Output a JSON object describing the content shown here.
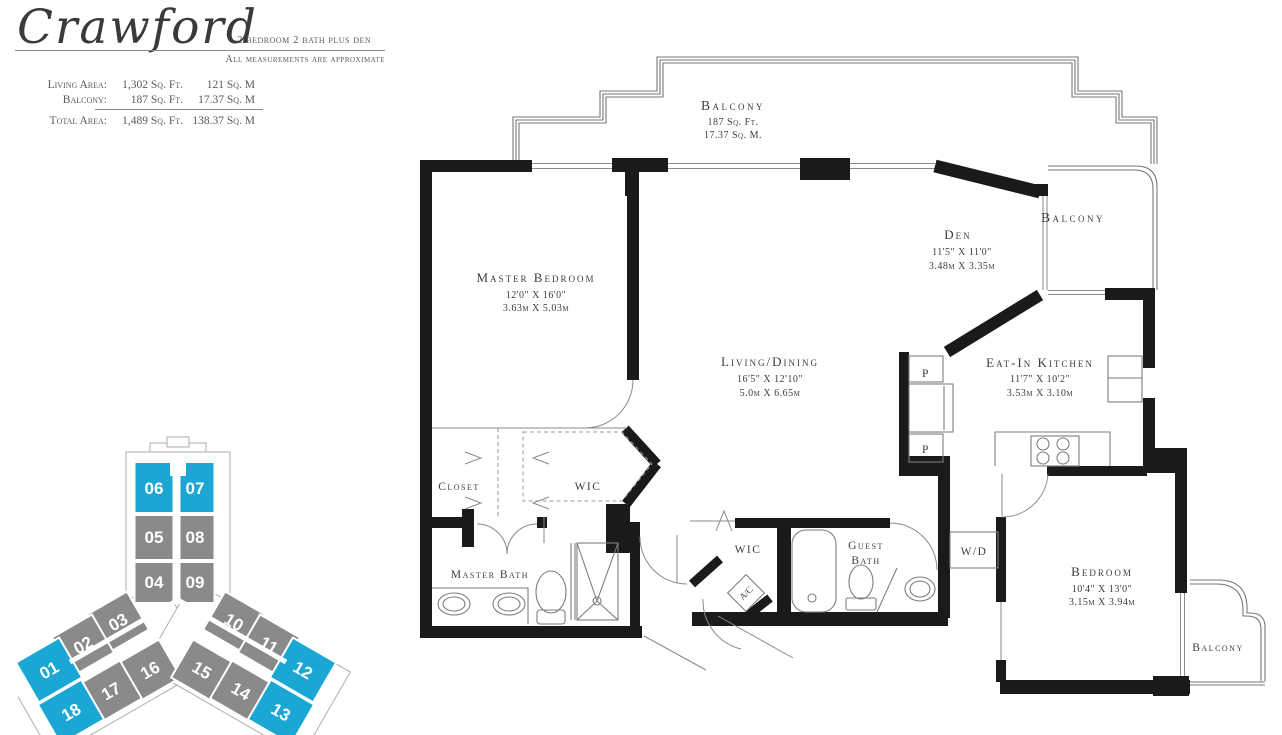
{
  "header": {
    "plan_name": "Crawford",
    "subtitle": "2 bedroom 2 bath plus den",
    "note": "All measurements are approximate",
    "stats": {
      "rows": [
        {
          "label": "Living Area:",
          "sqft": "1,302 Sq. Ft.",
          "sqm": "121 Sq. M"
        },
        {
          "label": "Balcony:",
          "sqft": "187 Sq. Ft.",
          "sqm": "17.37 Sq. M"
        },
        {
          "label": "Total Area:",
          "sqft": "1,489 Sq. Ft.",
          "sqm": "138.37 Sq. M"
        }
      ]
    }
  },
  "keyplan": {
    "highlight_color": "#1BA7D3",
    "unit_color": "#8A8A8A",
    "units": [
      {
        "label": "06",
        "highlighted": true
      },
      {
        "label": "07",
        "highlighted": true
      },
      {
        "label": "05",
        "highlighted": false
      },
      {
        "label": "08",
        "highlighted": false
      },
      {
        "label": "04",
        "highlighted": false
      },
      {
        "label": "09",
        "highlighted": false
      },
      {
        "label": "03",
        "highlighted": false
      },
      {
        "label": "10",
        "highlighted": false
      },
      {
        "label": "02",
        "highlighted": false
      },
      {
        "label": "11",
        "highlighted": false
      },
      {
        "label": "01",
        "highlighted": true
      },
      {
        "label": "12",
        "highlighted": true
      },
      {
        "label": "16",
        "highlighted": false
      },
      {
        "label": "15",
        "highlighted": false
      },
      {
        "label": "17",
        "highlighted": false
      },
      {
        "label": "14",
        "highlighted": false
      },
      {
        "label": "18",
        "highlighted": true
      },
      {
        "label": "13",
        "highlighted": true
      }
    ]
  },
  "plan": {
    "rooms": {
      "balcony_top": {
        "name": "Balcony",
        "line2": "187 Sq. Ft.",
        "line3": "17.37 Sq. M."
      },
      "balcony_right": {
        "name": "Balcony"
      },
      "balcony_bottom": {
        "name": "Balcony"
      },
      "master_bedroom": {
        "name": "Master Bedroom",
        "dim_ft": "12'0\" X 16'0\"",
        "dim_m": "3.63m X 5.03m"
      },
      "den": {
        "name": "Den",
        "dim_ft": "11'5\" X 11'0\"",
        "dim_m": "3.48m X 3.35m"
      },
      "living_dining": {
        "name": "Living/Dining",
        "dim_ft": "16'5\" X 12'10\"",
        "dim_m": "5.0m X 6.65m"
      },
      "eat_in_kitchen": {
        "name": "Eat-In Kitchen",
        "dim_ft": "11'7\" X 10'2\"",
        "dim_m": "3.53m X 3.10m"
      },
      "bedroom": {
        "name": "Bedroom",
        "dim_ft": "10'4\" X 13'0\"",
        "dim_m": "3.15m X 3.94m"
      },
      "master_bath": {
        "name": "Master Bath"
      },
      "guest_bath": {
        "line1": "Guest",
        "line2": "Bath"
      },
      "closet": {
        "name": "Closet"
      },
      "wic1": {
        "name": "WIC"
      },
      "wic2": {
        "name": "WIC"
      },
      "washer_dryer": {
        "name": "W/D"
      },
      "ac": {
        "name": "A/C"
      },
      "pantry": {
        "name": "P"
      }
    }
  }
}
